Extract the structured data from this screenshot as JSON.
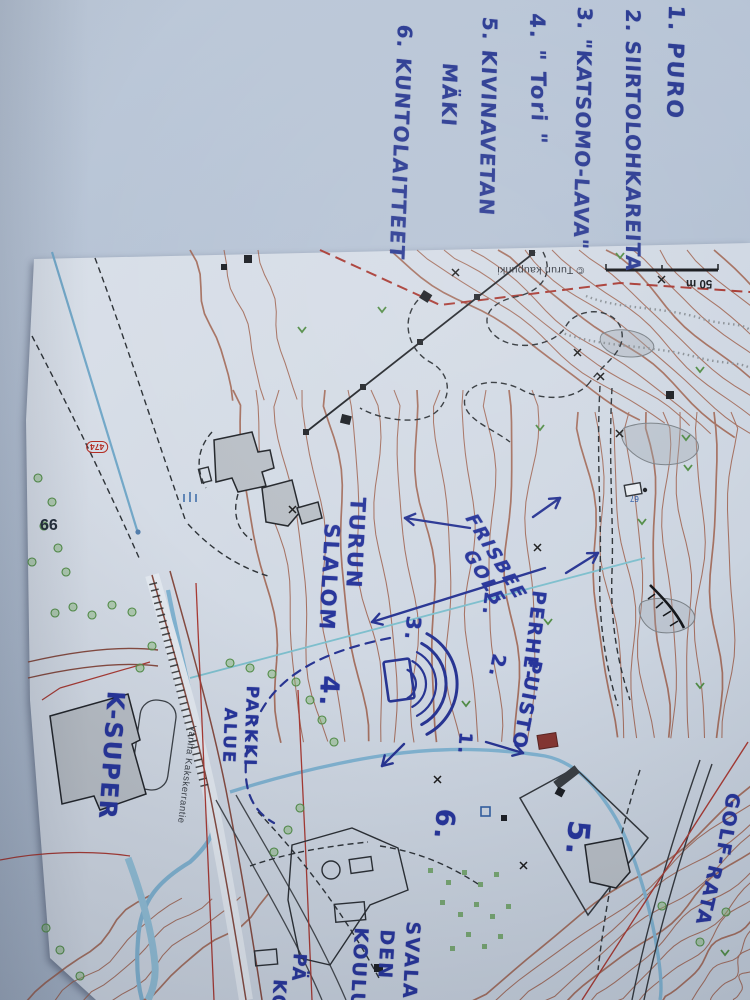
{
  "notes_list": {
    "ink": "#2a3a92",
    "lines": [
      {
        "text": "1. PURO"
      },
      {
        "text": "2. SIIRTOLOHKAREITA"
      },
      {
        "text": "3. \"KATSOMO-LAVA\""
      },
      {
        "text": "4. \" Tori \""
      },
      {
        "text": "5. KIVINAVETAN"
      },
      {
        "text": "MÄKI"
      },
      {
        "text": "6. KUNTOLAITTEET"
      }
    ]
  },
  "map": {
    "ink": "#27359b",
    "colors": {
      "contour": "#a0573f",
      "water": "#6fa9cc",
      "boundary_red": "#b03830",
      "vegetation_green": "#4e8f42"
    },
    "printed": {
      "credit": "© Turun kaupunki",
      "scale_label": "50 m",
      "street": "Vanha Kakskerrantie",
      "road_badge": "474",
      "building_number": "99",
      "house_67": "67"
    },
    "handwritten": {
      "slalom_line1": "TURUN",
      "slalom_line2": "SLALOM",
      "frisbee_line1": "FRISBEE",
      "frisbee_line2": "GOLF",
      "perhe_line1": "PERHE-",
      "perhe_line2": "PUISTO",
      "k_super": "K-SUPER",
      "parkki_line1": "PARKKI",
      "parkki_line2": "ALUE",
      "golf_line1": "GOLF-",
      "golf_line2": "RATA",
      "school_line1": "SVALA",
      "school_line2": "DEN",
      "school_line3": "KOULU",
      "edge_cut1": "PÄ",
      "edge_cut2": "KO",
      "marker_1": "1.",
      "marker_2a": "2.",
      "marker_2b": "2.",
      "marker_3": "3.",
      "marker_4": "4.",
      "marker_5": "5.",
      "marker_6": "6."
    }
  }
}
